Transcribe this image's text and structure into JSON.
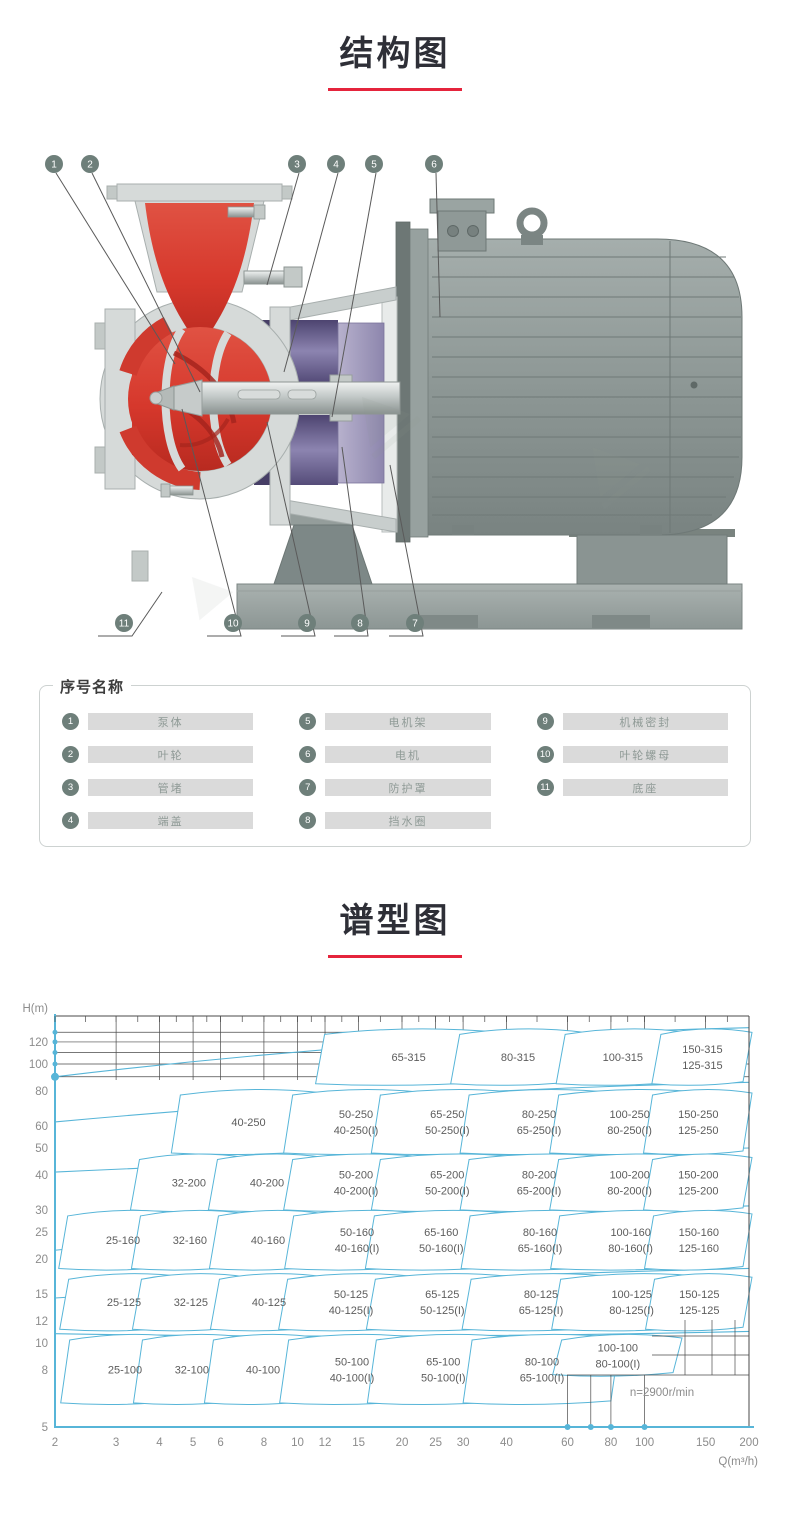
{
  "colors": {
    "accent_red": "#e5243c",
    "chart_blue": "#57b5d8",
    "grid_black": "#4a4a4a",
    "callout_circle": "#6e7f7a",
    "impeller_red": "#d6382c",
    "seal_purple": "#5a517f",
    "motor_grey": "#8d9795",
    "title_text": "#2e2f37",
    "axis_label_grey": "#8c8c8c"
  },
  "section_structure": {
    "title": "结构图"
  },
  "section_spectrum": {
    "title": "谱型图"
  },
  "diagram": {
    "callouts_top": [
      "1",
      "2",
      "3",
      "4",
      "5",
      "6"
    ],
    "callouts_bottom": [
      "11",
      "10",
      "9",
      "8",
      "7"
    ]
  },
  "parts_panel": {
    "title": "序号名称",
    "items": [
      {
        "no": "1",
        "name": "泵体"
      },
      {
        "no": "2",
        "name": "叶轮"
      },
      {
        "no": "3",
        "name": "管堵"
      },
      {
        "no": "4",
        "name": "端盖"
      },
      {
        "no": "5",
        "name": "电机架"
      },
      {
        "no": "6",
        "name": "电机"
      },
      {
        "no": "7",
        "name": "防护罩"
      },
      {
        "no": "8",
        "name": "挡水圈"
      },
      {
        "no": "9",
        "name": "机械密封"
      },
      {
        "no": "10",
        "name": "叶轮螺母"
      },
      {
        "no": "11",
        "name": "底座"
      }
    ]
  },
  "chart_data": {
    "type": "area",
    "title": "谱型图",
    "xlabel": "Q(m³/h)",
    "ylabel": "H(m)",
    "x_scale": "log",
    "y_scale": "log",
    "xlim": [
      2,
      200
    ],
    "ylim": [
      5,
      148
    ],
    "x_ticks": [
      2,
      3,
      4,
      5,
      6,
      8,
      10,
      12,
      15,
      20,
      25,
      30,
      40,
      60,
      80,
      100,
      150,
      200
    ],
    "y_ticks": [
      120,
      100,
      80,
      60,
      50,
      40,
      30,
      25,
      20,
      15,
      12,
      10,
      8,
      5
    ],
    "annotation": "n=2900r/min",
    "grid": "partial",
    "legend": "none",
    "regions": [
      {
        "labels": [
          "65-315"
        ],
        "q": [
          11.5,
          37
        ],
        "h": [
          85,
          132
        ]
      },
      {
        "labels": [
          "80-315"
        ],
        "q": [
          28,
          64
        ],
        "h": [
          85,
          132
        ]
      },
      {
        "labels": [
          "100-315"
        ],
        "q": [
          56,
          127
        ],
        "h": [
          85,
          132
        ]
      },
      {
        "labels": [
          "150-315",
          "125-315"
        ],
        "q": [
          105,
          200
        ],
        "h": [
          85,
          132
        ]
      },
      {
        "labels": [
          "40-250"
        ],
        "q": [
          4.3,
          11.2
        ],
        "h": [
          48,
          80
        ]
      },
      {
        "labels": [
          "50-250",
          "40-250(I)"
        ],
        "q": [
          9,
          22
        ],
        "h": [
          48,
          80
        ]
      },
      {
        "labels": [
          "65-250",
          "50-250(I)"
        ],
        "q": [
          16,
          41
        ],
        "h": [
          48,
          80
        ]
      },
      {
        "labels": [
          "80-250",
          "65-250(I)"
        ],
        "q": [
          30,
          80
        ],
        "h": [
          48,
          80
        ]
      },
      {
        "labels": [
          "100-250",
          "80-250(I)"
        ],
        "q": [
          54,
          146
        ],
        "h": [
          48,
          80
        ]
      },
      {
        "labels": [
          "150-250",
          "125-250"
        ],
        "q": [
          100,
          200
        ],
        "h": [
          48,
          80
        ]
      },
      {
        "labels": [
          "32-200"
        ],
        "q": [
          3.3,
          6.7
        ],
        "h": [
          30,
          47
        ]
      },
      {
        "labels": [
          "40-200"
        ],
        "q": [
          5.5,
          11.2
        ],
        "h": [
          30,
          47
        ]
      },
      {
        "labels": [
          "50-200",
          "40-200(I)"
        ],
        "q": [
          9,
          22
        ],
        "h": [
          30,
          47
        ]
      },
      {
        "labels": [
          "65-200",
          "50-200(I)"
        ],
        "q": [
          16,
          41
        ],
        "h": [
          30,
          47
        ]
      },
      {
        "labels": [
          "80-200",
          "65-200(I)"
        ],
        "q": [
          30,
          80
        ],
        "h": [
          30,
          47
        ]
      },
      {
        "labels": [
          "100-200",
          "80-200(I)"
        ],
        "q": [
          54,
          146
        ],
        "h": [
          30,
          47
        ]
      },
      {
        "labels": [
          "150-200",
          "125-200"
        ],
        "q": [
          100,
          200
        ],
        "h": [
          30,
          47
        ]
      },
      {
        "labels": [
          "25-160"
        ],
        "q": [
          2.05,
          4.5
        ],
        "h": [
          18.5,
          29.5
        ]
      },
      {
        "labels": [
          "32-160"
        ],
        "q": [
          3.3,
          6.7
        ],
        "h": [
          18.5,
          29.5
        ]
      },
      {
        "labels": [
          "40-160"
        ],
        "q": [
          5.5,
          11.2
        ],
        "h": [
          18.5,
          29.5
        ]
      },
      {
        "labels": [
          "50-160",
          "40-160(I)"
        ],
        "q": [
          9,
          22
        ],
        "h": [
          18.5,
          29.5
        ]
      },
      {
        "labels": [
          "65-160",
          "50-160(I)"
        ],
        "q": [
          16,
          41
        ],
        "h": [
          18.5,
          29.5
        ]
      },
      {
        "labels": [
          "80-160",
          "65-160(I)"
        ],
        "q": [
          30,
          80
        ],
        "h": [
          18.5,
          29.5
        ]
      },
      {
        "labels": [
          "100-160",
          "80-160(I)"
        ],
        "q": [
          54,
          146
        ],
        "h": [
          18.5,
          29.5
        ]
      },
      {
        "labels": [
          "150-160",
          "125-160"
        ],
        "q": [
          100,
          200
        ],
        "h": [
          18.5,
          29.5
        ]
      },
      {
        "labels": [
          "25-125"
        ],
        "q": [
          2.05,
          4.5
        ],
        "h": [
          11.2,
          17.5
        ]
      },
      {
        "labels": [
          "32-125"
        ],
        "q": [
          3.3,
          6.7
        ],
        "h": [
          11.2,
          17.5
        ]
      },
      {
        "labels": [
          "40-125"
        ],
        "q": [
          5.5,
          11.2
        ],
        "h": [
          11.2,
          17.5
        ]
      },
      {
        "labels": [
          "50-125",
          "40-125(I)"
        ],
        "q": [
          9,
          22
        ],
        "h": [
          11.2,
          17.5
        ]
      },
      {
        "labels": [
          "65-125",
          "50-125(I)"
        ],
        "q": [
          16,
          41
        ],
        "h": [
          11.2,
          17.5
        ]
      },
      {
        "labels": [
          "80-125",
          "65-125(I)"
        ],
        "q": [
          30,
          80
        ],
        "h": [
          11.2,
          17.5
        ]
      },
      {
        "labels": [
          "100-125",
          "80-125(I)"
        ],
        "q": [
          54,
          146
        ],
        "h": [
          11.2,
          17.5
        ]
      },
      {
        "labels": [
          "150-125",
          "125-125"
        ],
        "q": [
          100,
          200
        ],
        "h": [
          11.2,
          17.5
        ]
      },
      {
        "labels": [
          "25-100"
        ],
        "q": [
          2.05,
          4.5
        ],
        "h": [
          6.1,
          10.6
        ]
      },
      {
        "labels": [
          "32-100"
        ],
        "q": [
          3.3,
          6.7
        ],
        "h": [
          6.1,
          10.6
        ]
      },
      {
        "labels": [
          "40-100"
        ],
        "q": [
          5.5,
          11.2
        ],
        "h": [
          6.1,
          10.6
        ]
      },
      {
        "labels": [
          "50-100",
          "40-100(I)"
        ],
        "q": [
          9,
          22
        ],
        "h": [
          6.1,
          10.6
        ]
      },
      {
        "labels": [
          "65-100",
          "50-100(I)"
        ],
        "q": [
          16,
          41
        ],
        "h": [
          6.1,
          10.6
        ]
      },
      {
        "labels": [
          "80-100",
          "65-100(I)"
        ],
        "q": [
          30,
          80
        ],
        "h": [
          6.1,
          10.6
        ]
      },
      {
        "labels": [
          "100-100",
          "80-100(I)"
        ],
        "q": [
          54,
          120
        ],
        "h": [
          7.7,
          10.6
        ]
      }
    ]
  }
}
